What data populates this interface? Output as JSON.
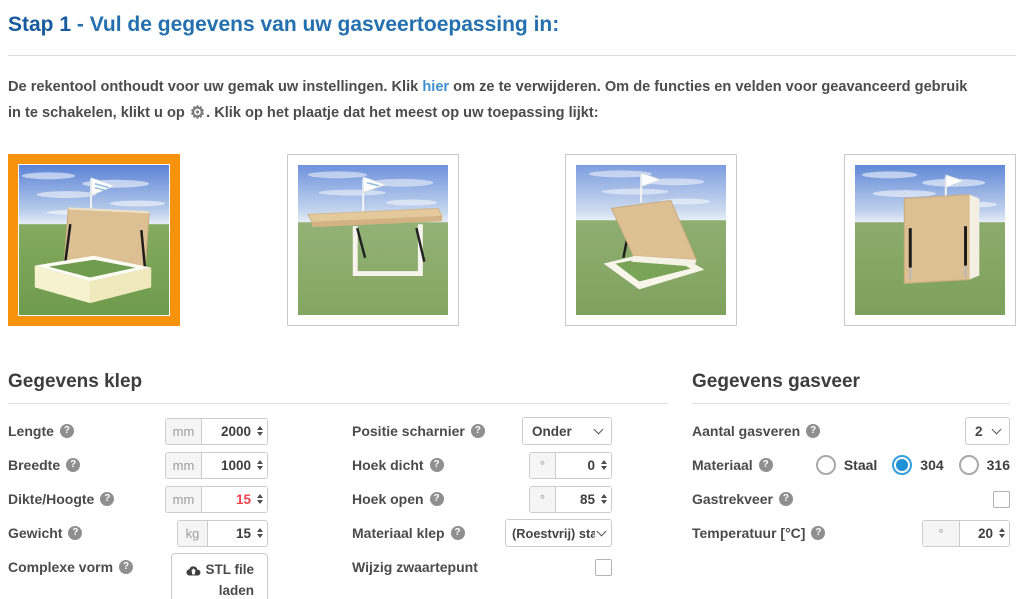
{
  "title": {
    "step": "Stap 1",
    "rest": " - Vul de gegevens van uw gasveertoepassing in:"
  },
  "intro": {
    "before_link": "De rekentool onthoudt voor uw gemak uw instellingen. Klik ",
    "link": "hier",
    "after_link": " om ze te verwijderen. Om de functies en velden voor geavanceerd gebruik in te schakelen, klikt u op ",
    "gear_icon": "⚙",
    "after_gear": ". Klik op het plaatje dat het meest op uw toepassing lijkt:"
  },
  "thumbnails": [
    {
      "name": "kist-met-klep-open",
      "selected": true
    },
    {
      "name": "horizontale-luifel",
      "selected": false
    },
    {
      "name": "schuin-luik-open",
      "selected": false
    },
    {
      "name": "verticale-klep",
      "selected": false
    }
  ],
  "klep": {
    "heading": "Gegevens klep",
    "lengte": {
      "label": "Lengte",
      "unit": "mm",
      "value": "2000"
    },
    "breedte": {
      "label": "Breedte",
      "unit": "mm",
      "value": "1000"
    },
    "dikte": {
      "label": "Dikte/Hoogte",
      "unit": "mm",
      "value": "15",
      "value_color": "#f2464e"
    },
    "gewicht": {
      "label": "Gewicht",
      "unit": "kg",
      "value": "15"
    },
    "complexe_vorm": {
      "label": "Complexe vorm",
      "button": "STL file laden"
    },
    "positie_scharnier": {
      "label": "Positie scharnier",
      "value": "Onder"
    },
    "hoek_dicht": {
      "label": "Hoek dicht",
      "unit": "°",
      "value": "0"
    },
    "hoek_open": {
      "label": "Hoek open",
      "unit": "°",
      "value": "85"
    },
    "materiaal_klep": {
      "label": "Materiaal klep",
      "value": "(Roestvrij) staal"
    },
    "wijzig_zwaartepunt": {
      "label": "Wijzig zwaartepunt",
      "checked": false
    }
  },
  "gasveer": {
    "heading": "Gegevens gasveer",
    "aantal": {
      "label": "Aantal gasveren",
      "value": "2"
    },
    "materiaal": {
      "label": "Materiaal",
      "options": [
        "Staal",
        "304",
        "316"
      ],
      "selected": "304"
    },
    "gastrekveer": {
      "label": "Gastrekveer",
      "checked": false
    },
    "temperatuur": {
      "label": "Temperatuur [°C]",
      "unit": "°",
      "value": "20"
    }
  },
  "icons": {
    "help": "?",
    "gear": "⚙",
    "cloud_upload": "cloud-upload",
    "chevron_down": "chevron-down",
    "stepper": "up-down-arrows"
  },
  "colors": {
    "accent_orange": "#f6920c",
    "title_blue_dark": "#175a9d",
    "title_blue": "#2470ae",
    "link_blue": "#3e8fd0",
    "radio_blue": "#1e90d6",
    "warning_red": "#f2464e"
  }
}
